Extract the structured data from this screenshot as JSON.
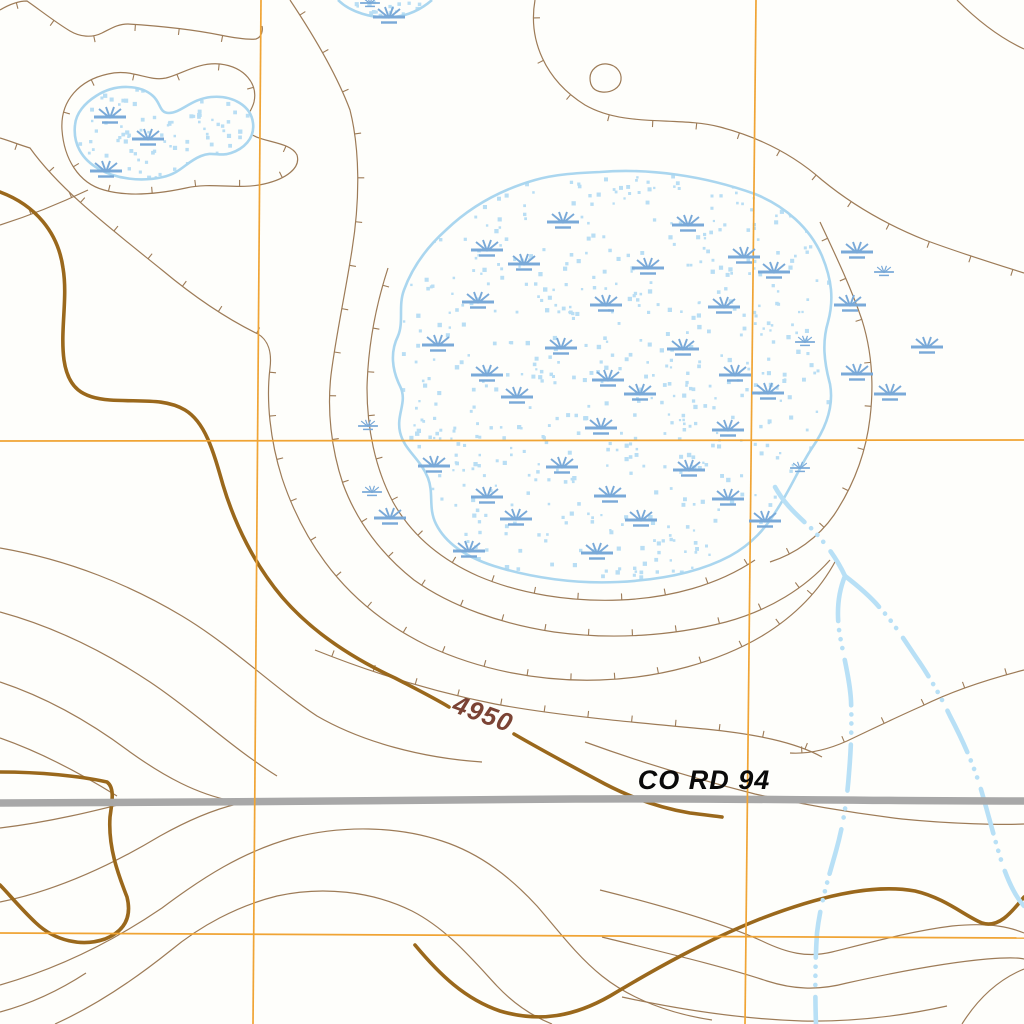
{
  "map": {
    "road": {
      "label": "CO RD 94",
      "label_x": 704,
      "label_y": 789
    },
    "contour_label": {
      "text": "4950",
      "x": 480,
      "y": 722,
      "rotation_deg": 20
    },
    "grid": {
      "vertical_x": [
        259,
        750
      ],
      "horizontal_y": [
        441,
        936
      ]
    },
    "colors": {
      "background": "#fefefb",
      "contour_thin": "#9d7b57",
      "contour_index": "#9a681c",
      "contour_label": "#7b4334",
      "grid": "#f0a434",
      "road": "#a8a8a8",
      "road_label": "#0a0a0a",
      "water_outline": "#aad6ef",
      "water_stipple": "#b9def4",
      "marsh_symbol": "#79a9d8",
      "stream": "#b8e0f6"
    },
    "marsh_symbols": {
      "large": [
        [
          563,
          222
        ],
        [
          688,
          225
        ],
        [
          487,
          250
        ],
        [
          524,
          264
        ],
        [
          648,
          268
        ],
        [
          744,
          257
        ],
        [
          774,
          272
        ],
        [
          478,
          302
        ],
        [
          606,
          305
        ],
        [
          724,
          307
        ],
        [
          438,
          345
        ],
        [
          561,
          348
        ],
        [
          683,
          349
        ],
        [
          487,
          375
        ],
        [
          517,
          397
        ],
        [
          608,
          380
        ],
        [
          640,
          394
        ],
        [
          735,
          375
        ],
        [
          768,
          393
        ],
        [
          601,
          428
        ],
        [
          728,
          430
        ],
        [
          434,
          466
        ],
        [
          562,
          467
        ],
        [
          689,
          470
        ],
        [
          487,
          497
        ],
        [
          610,
          496
        ],
        [
          728,
          499
        ],
        [
          516,
          519
        ],
        [
          641,
          520
        ],
        [
          765,
          521
        ],
        [
          469,
          551
        ],
        [
          597,
          553
        ],
        [
          390,
          518
        ],
        [
          110,
          117
        ],
        [
          148,
          139
        ],
        [
          106,
          171
        ],
        [
          389,
          17
        ],
        [
          857,
          252
        ],
        [
          850,
          305
        ],
        [
          927,
          347
        ],
        [
          857,
          374
        ],
        [
          890,
          394
        ]
      ],
      "small": [
        [
          370,
          3
        ],
        [
          884,
          272
        ],
        [
          805,
          342
        ],
        [
          800,
          468
        ],
        [
          368,
          426
        ],
        [
          372,
          492
        ]
      ]
    }
  }
}
